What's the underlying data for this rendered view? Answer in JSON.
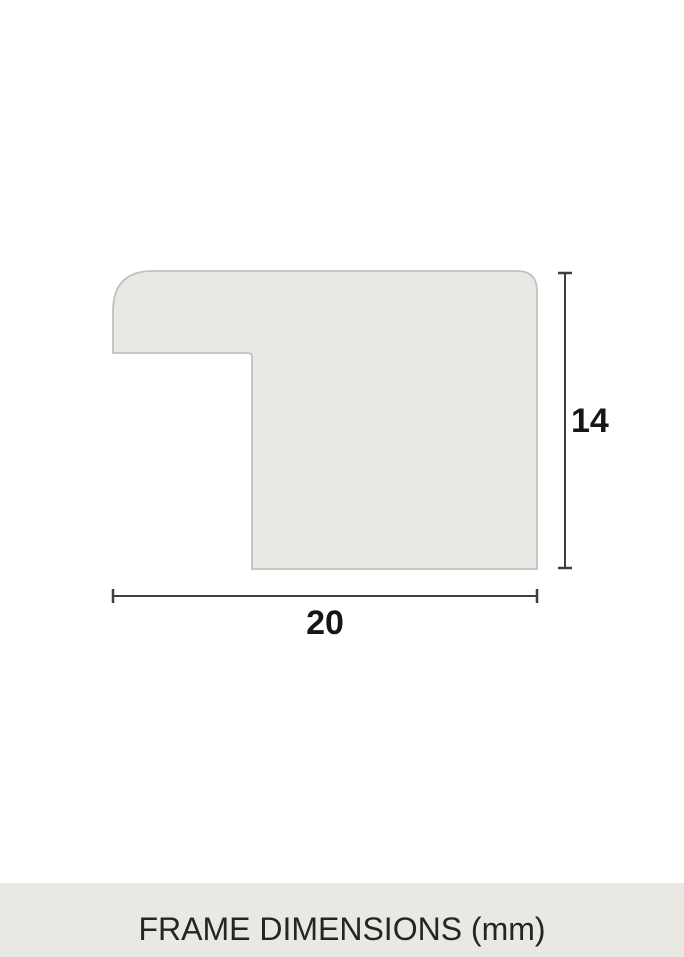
{
  "diagram": {
    "height_label": "14",
    "width_label": "20"
  },
  "footer": {
    "title": "FRAME DIMENSIONS (mm)"
  },
  "colors": {
    "canvas_bg": "#ffffff",
    "profile_fill": "#e9e8e5",
    "profile_stroke": "#c1c1be",
    "dimension_line": "#3f3f3f",
    "dimension_label": "#161616",
    "footer_bg": "#e9e8e3",
    "footer_text": "#26261f"
  }
}
